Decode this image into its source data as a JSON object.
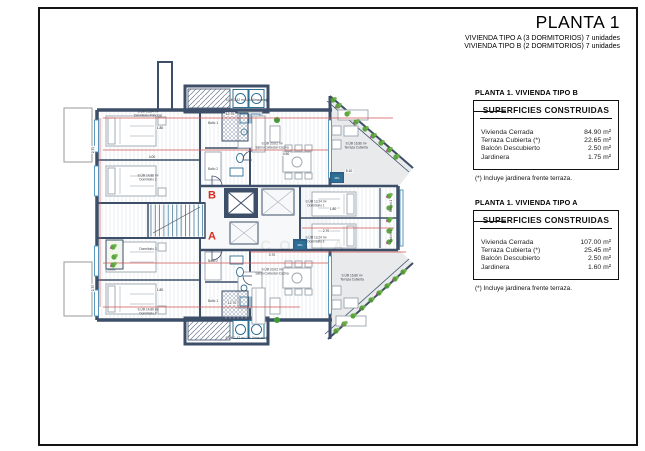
{
  "title_block": {
    "title": "PLANTA 1",
    "subtitle_a": "VIVIENDA TIPO A (3 DORMITORIOS) 7 unidades",
    "subtitle_b": "VIVIENDA TIPO B (2 DORMITORIOS) 7 unidades"
  },
  "tables": [
    {
      "header": "PLANTA 1. VIVIENDA TIPO B",
      "box_title": "SUPERFICIES CONSTRUIDAS",
      "rows": [
        {
          "label": "Vivienda Cerrada",
          "value": "84.90 m²"
        },
        {
          "label": "Terraza Cubierta (*)",
          "value": "22.65 m²"
        },
        {
          "label": "Balcón Descubierto",
          "value": "2.50 m²"
        },
        {
          "label": "Jardinera",
          "value": "1.75 m²"
        }
      ],
      "footnote": "(*) Incluye jardinera frente terraza."
    },
    {
      "header": "PLANTA 1. VIVIENDA TIPO A",
      "box_title": "SUPERFICIES CONSTRUIDAS",
      "rows": [
        {
          "label": "Vivienda Cerrada",
          "value": "107.00 m²"
        },
        {
          "label": "Terraza Cubierta (*)",
          "value": "25.45 m²"
        },
        {
          "label": "Balcón Descubierto",
          "value": "2.50 m²"
        },
        {
          "label": "Jardinera",
          "value": "1.60 m²"
        }
      ],
      "footnote": "(*) Incluye jardinera frente terraza."
    }
  ],
  "plan": {
    "watermark": "COSTA",
    "unit_labels": [
      {
        "text": "B",
        "x": 212,
        "y": 196
      },
      {
        "text": "A",
        "x": 212,
        "y": 237
      }
    ],
    "room_labels": [
      {
        "text": "S.Útil 15,84 m²\nDormitorio Principal",
        "x": 148,
        "y": 114
      },
      {
        "text": "S.Útil 14,86 m²\nDormitorio 2",
        "x": 148,
        "y": 178
      },
      {
        "text": "Dormitorio 3",
        "x": 148,
        "y": 250
      },
      {
        "text": "S.Útil 14,86 m²\nDormitorio 2",
        "x": 148,
        "y": 312
      },
      {
        "text": "S.Útil 20,02 m²\nSalón-Comedor-Cocina",
        "x": 272,
        "y": 146
      },
      {
        "text": "S.Útil 20,02 m²\nSalón-Comedor-Cocina",
        "x": 272,
        "y": 272
      },
      {
        "text": "S.Útil 16,86 m²\nTerraza Cubierta",
        "x": 356,
        "y": 146
      },
      {
        "text": "S.Útil 16,86 m²\nTerraza Cubierta",
        "x": 352,
        "y": 278
      },
      {
        "text": "S.Útil 1,42 m² Lav-Almacenaje",
        "x": 247,
        "y": 101
      },
      {
        "text": "S.Útil 1,42 m² Lav-Almacenaje",
        "x": 247,
        "y": 339
      },
      {
        "text": "S.Útil 13,24 m²\nDormitorio 1",
        "x": 316,
        "y": 204
      },
      {
        "text": "S.Útil 13,24 m²\nDormitorio 1",
        "x": 316,
        "y": 240
      },
      {
        "text": "Baño 1",
        "x": 213,
        "y": 124
      },
      {
        "text": "Baño 2",
        "x": 213,
        "y": 170
      },
      {
        "text": "Baño 2",
        "x": 213,
        "y": 262
      },
      {
        "text": "Baño 1",
        "x": 213,
        "y": 302
      },
      {
        "text": "Balcón 1",
        "x": 392,
        "y": 206,
        "rot": -90
      },
      {
        "text": "Balcón 1",
        "x": 392,
        "y": 236,
        "rot": -90
      },
      {
        "text": "MG",
        "x": 337,
        "y": 178,
        "cls": "mg"
      },
      {
        "text": "MG",
        "x": 300,
        "y": 245,
        "cls": "mg"
      }
    ],
    "dim_labels": [
      {
        "text": "12.70",
        "x": 230,
        "y": 114
      },
      {
        "text": "1.80",
        "x": 160,
        "y": 128
      },
      {
        "text": "4.00",
        "x": 152,
        "y": 157
      },
      {
        "text": "2.70",
        "x": 93,
        "y": 150,
        "rot": -90
      },
      {
        "text": "4.50",
        "x": 286,
        "y": 154
      },
      {
        "text": "5.10",
        "x": 349,
        "y": 171
      },
      {
        "text": "1.80",
        "x": 333,
        "y": 209
      },
      {
        "text": "2.70",
        "x": 326,
        "y": 231
      },
      {
        "text": "0.70",
        "x": 272,
        "y": 255
      },
      {
        "text": "1.80",
        "x": 160,
        "y": 290
      },
      {
        "text": "2.70",
        "x": 93,
        "y": 288,
        "rot": -90
      },
      {
        "text": "12.70",
        "x": 232,
        "y": 303
      }
    ],
    "plants": [
      [
        338,
        106
      ],
      [
        347,
        114
      ],
      [
        356,
        122
      ],
      [
        365,
        129
      ],
      [
        373,
        136
      ],
      [
        381,
        143
      ],
      [
        389,
        150
      ],
      [
        396,
        157
      ],
      [
        389,
        196
      ],
      [
        389,
        208
      ],
      [
        389,
        220
      ],
      [
        389,
        231
      ],
      [
        389,
        242
      ],
      [
        403,
        272
      ],
      [
        395,
        279
      ],
      [
        387,
        286
      ],
      [
        379,
        293
      ],
      [
        371,
        300
      ],
      [
        362,
        308
      ],
      [
        353,
        316
      ],
      [
        344,
        324
      ],
      [
        336,
        331
      ],
      [
        113,
        247
      ],
      [
        114,
        257
      ],
      [
        113,
        265
      ],
      [
        333,
        100
      ]
    ],
    "colors": {
      "wall": "#3d4e68",
      "red": "#d92b1f",
      "dim_line": "#d05555",
      "plant": "#4e9b2e",
      "plant_light": "#71b24a",
      "flower": "#b83a9e",
      "fixture": "#2e6f96",
      "terrace": "#e8eaeb"
    }
  }
}
